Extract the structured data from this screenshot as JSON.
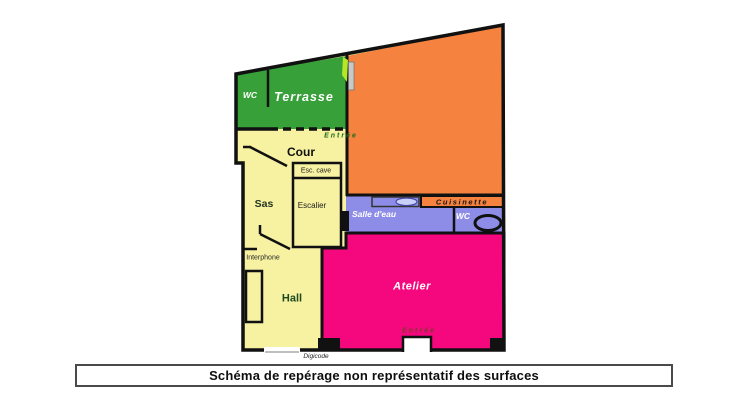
{
  "caption": {
    "text": "Schéma de repérage non représentatif des surfaces"
  },
  "plan": {
    "rooms": {
      "wc_terrasse": "WC",
      "terrasse": "Terrasse",
      "cour": "Cour",
      "sas": "Sas",
      "esc_cave": "Esc. cave",
      "escalier": "Escalier",
      "salle_deau": "Salle d'eau",
      "cuisinette": "Cuisinette",
      "wc_bains": "WC",
      "hall": "Hall",
      "atelier": "Atelier"
    },
    "annotations": {
      "entree_haut": "Entrée",
      "interphone": "Interphone",
      "entree_bas": "Entrée",
      "digicode": "Digicode"
    }
  },
  "colors": {
    "terrasse_green": "#38a038",
    "atelier_orange": "#f5823f",
    "circulation_yellow": "#f7f1a2",
    "atelier_pink": "#f5087e",
    "sanitaire_purple": "#8d8ce6",
    "wall_black": "#111111",
    "door_gray": "#c9c9c9",
    "accent_chartreuse": "#b4e62a",
    "entree_haut_text": "#1d6a1d",
    "entree_bas_text": "#7b3a2e"
  }
}
